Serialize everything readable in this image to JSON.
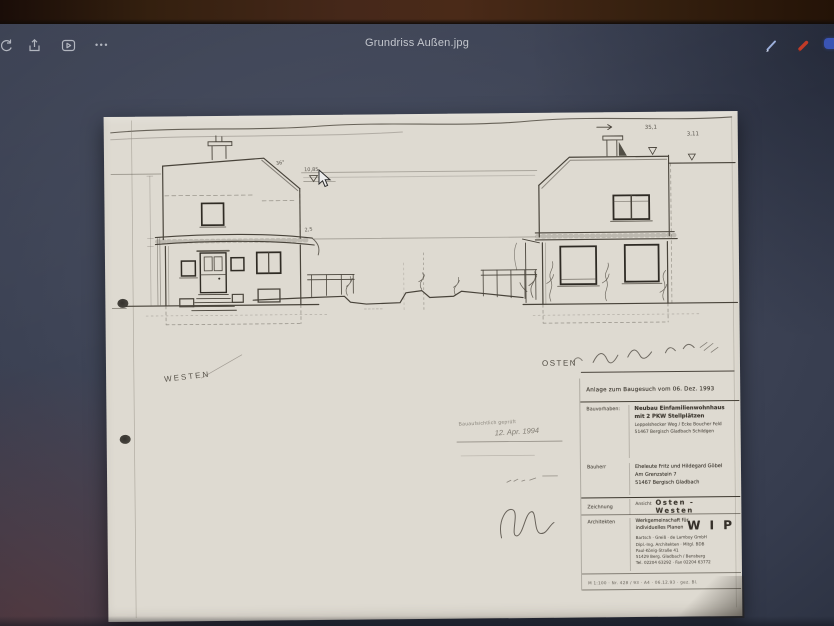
{
  "window": {
    "title": "Grundriss Außen.jpg"
  },
  "toolbar": {
    "more_glyph": "•••"
  },
  "colors": {
    "accent_red": "#c23b28",
    "accent_blue": "#3a54b4",
    "pen": "#9db0dc",
    "paper": "#dedad1",
    "screen": "#3e4456"
  },
  "sheet": {
    "label_west": "WESTEN",
    "label_east": "OSTEN",
    "stamp_line": "Bauaufsichtlich geprüft",
    "stamp_date": "12. Apr. 1994",
    "ann": {
      "left_angle": "36°",
      "left_level": "10,85",
      "left_eave": "2,5",
      "right_level1": "35,1",
      "right_level2": "3,11"
    },
    "titleblock": {
      "anlage": "Anlage zum Baugesuch vom   06. Dez. 1993",
      "bauvorhaben_label": "Bauvorhaben:",
      "bauvorhaben_1": "Neubau Einfamilienwohnhaus",
      "bauvorhaben_2": "mit 2 PKW Stellplätzen",
      "bauvorhaben_3": "Leppelshecker Weg / Ecke Boucher Feld",
      "bauvorhaben_4": "51467 Bergisch Gladbach Schildgen",
      "bauherr_label": "Bauherr",
      "bauherr_1": "Eheleute Fritz und Hildegard Göbel",
      "bauherr_2": "Am Grenzstein 7",
      "bauherr_3": "51467 Bergisch Gladbach",
      "zeichnung_label": "Zeichnung",
      "zeichnung_prefix": "Ansicht",
      "zeichnung_value": "Osten - Westen",
      "architekten_label": "Architekten",
      "arch_1": "Werkgemeinschaft für",
      "arch_2": "individuelles Planen",
      "arch_wip": "W I P",
      "arch_addr_1": "Bartsch · Greiß · de Lamboy GmbH",
      "arch_addr_2": "Dipl.-Ing. Architekten · Mitgl. BDB",
      "arch_addr_3": "Paul-König-Straße 41",
      "arch_addr_4": "51429 Berg. Gladbach / Bensberg",
      "arch_addr_5": "Tel. 02204 63292 · Fax 02204 63772",
      "footer": "M 1:100 · Nr. 428 / 93 · A4 · 06.12.93 · gez. Bl."
    }
  }
}
